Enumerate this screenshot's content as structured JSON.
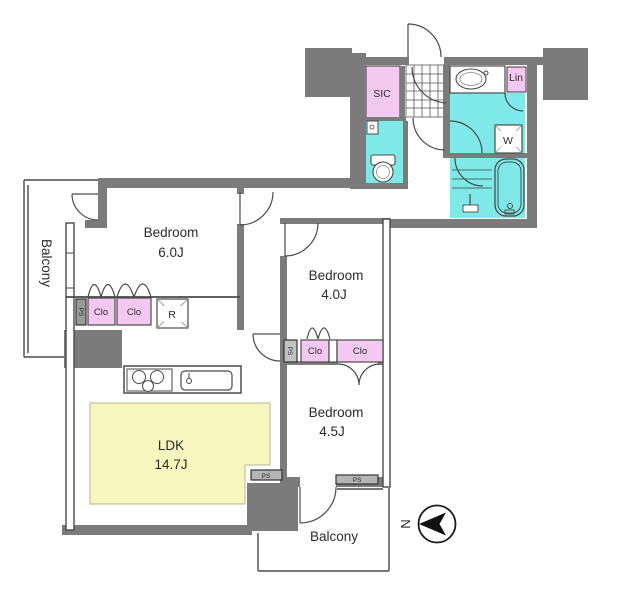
{
  "rooms": {
    "balcony_left": "Balcony",
    "bedroom_a": {
      "label": "Bedroom",
      "area": "6.0J"
    },
    "bedroom_b": {
      "label": "Bedroom",
      "area": "4.0J"
    },
    "bedroom_c": {
      "label": "Bedroom",
      "area": "4.5J"
    },
    "ldk": {
      "label": "LDK",
      "area": "14.7J"
    },
    "balcony_bottom": "Balcony"
  },
  "labels": {
    "sic": "SIC",
    "lin": "Lin",
    "washer": "W",
    "fridge": "R",
    "closet": "Clo",
    "pipe_space": "PS",
    "north": "N"
  },
  "colors": {
    "wall_gray": "#7b7b7b",
    "wet_area_cyan": "#7fe9e8",
    "closet_pink": "#f3c8f1",
    "ldk_yellow": "#f6f6bf",
    "line": "#4a4a4a"
  }
}
